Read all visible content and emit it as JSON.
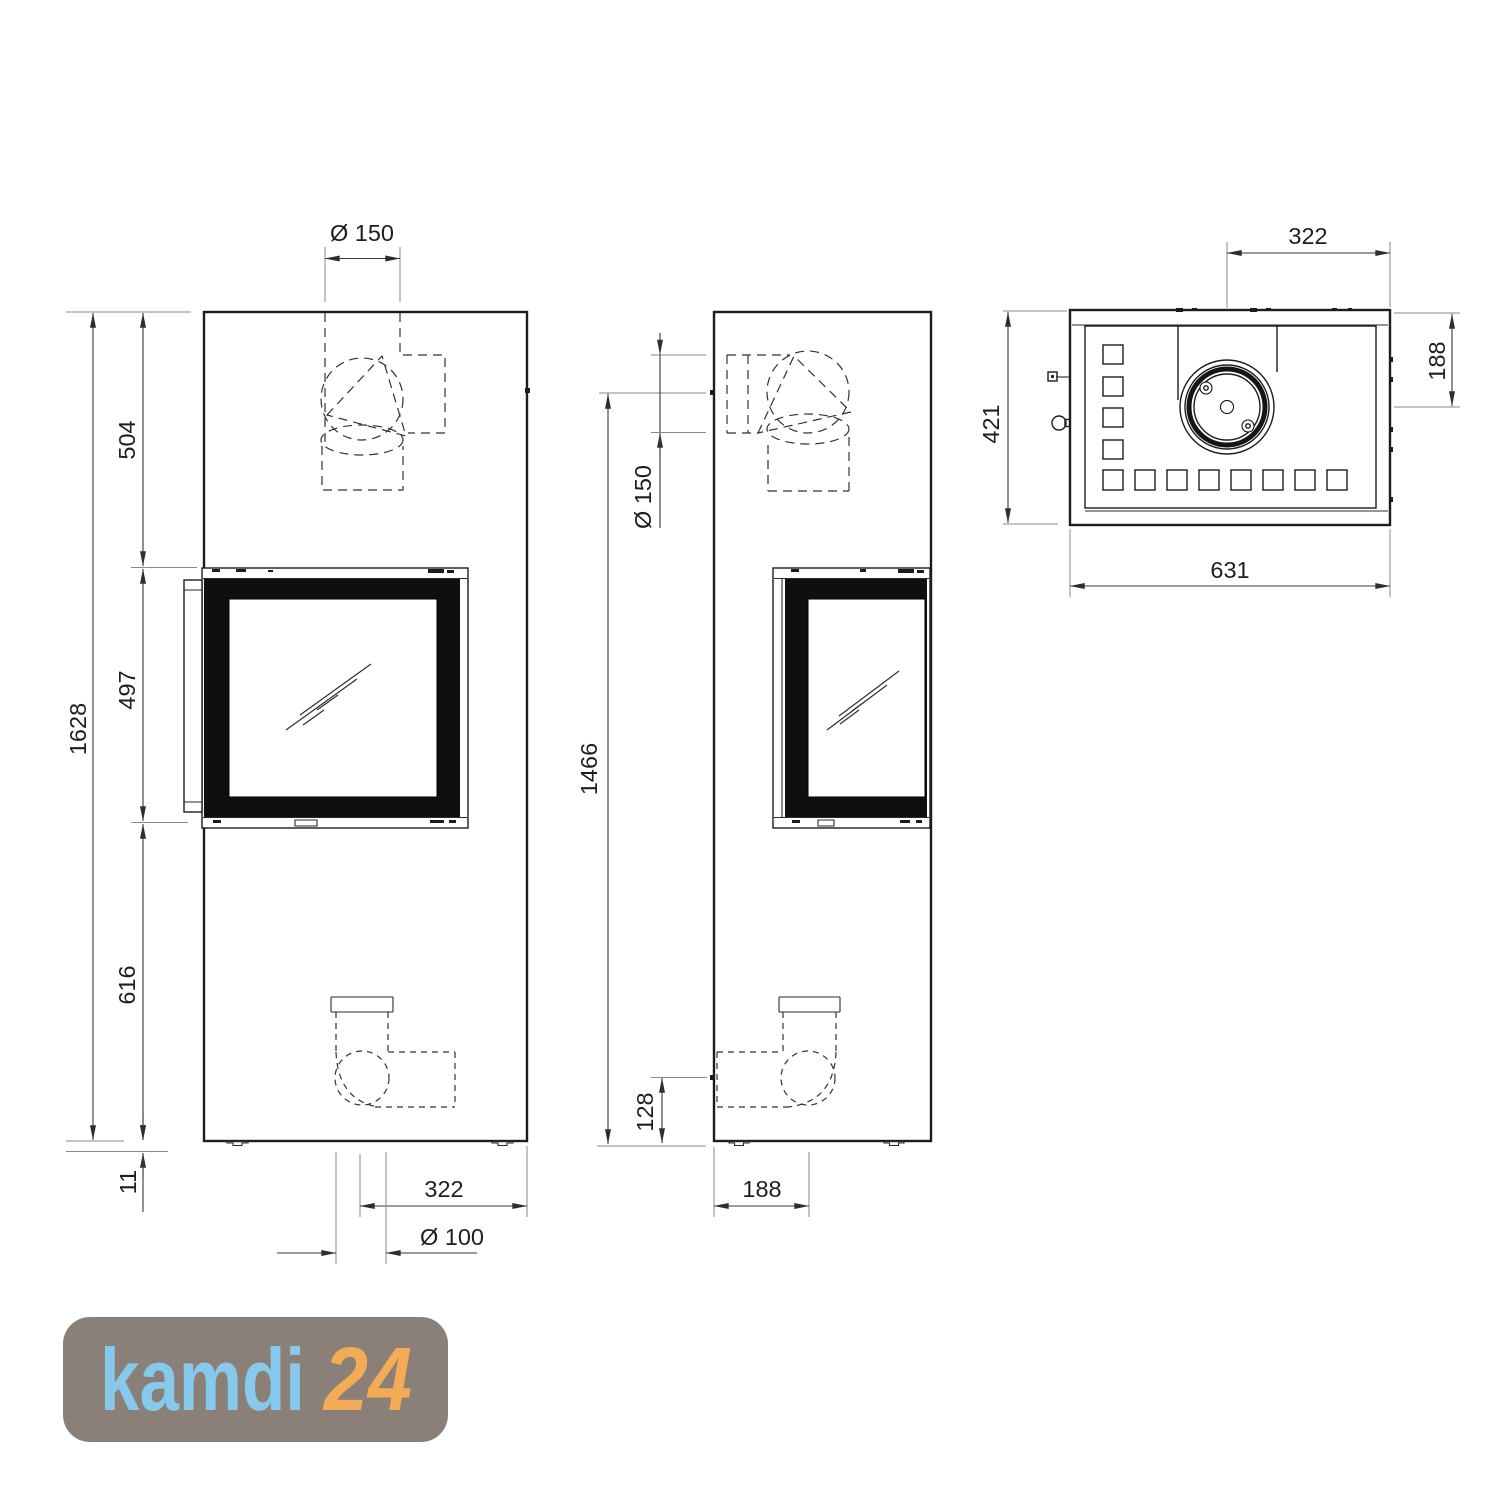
{
  "drawing": {
    "front_view": {
      "dimensions": {
        "flue_diameter": "Ø 150",
        "upper_section_height": "504",
        "door_height": "497",
        "lower_section_height": "616",
        "total_height": "1628",
        "base_clearance": "11",
        "intake_offset_from_right": "322",
        "intake_diameter": "Ø 100"
      }
    },
    "side_view": {
      "dimensions": {
        "flue_center_height": "1466",
        "flue_diameter": "Ø 150",
        "intake_center_height": "128",
        "base_depth": "188"
      }
    },
    "top_view": {
      "dimensions": {
        "flue_center_from_right": "322",
        "flue_center_from_back": "188",
        "depth": "421",
        "width": "631"
      }
    }
  },
  "logo": {
    "brand": "kamdi",
    "suffix": "24",
    "colors": {
      "background": "#8a8078",
      "brand": "#87c9ec",
      "suffix": "#f4ab55"
    }
  }
}
